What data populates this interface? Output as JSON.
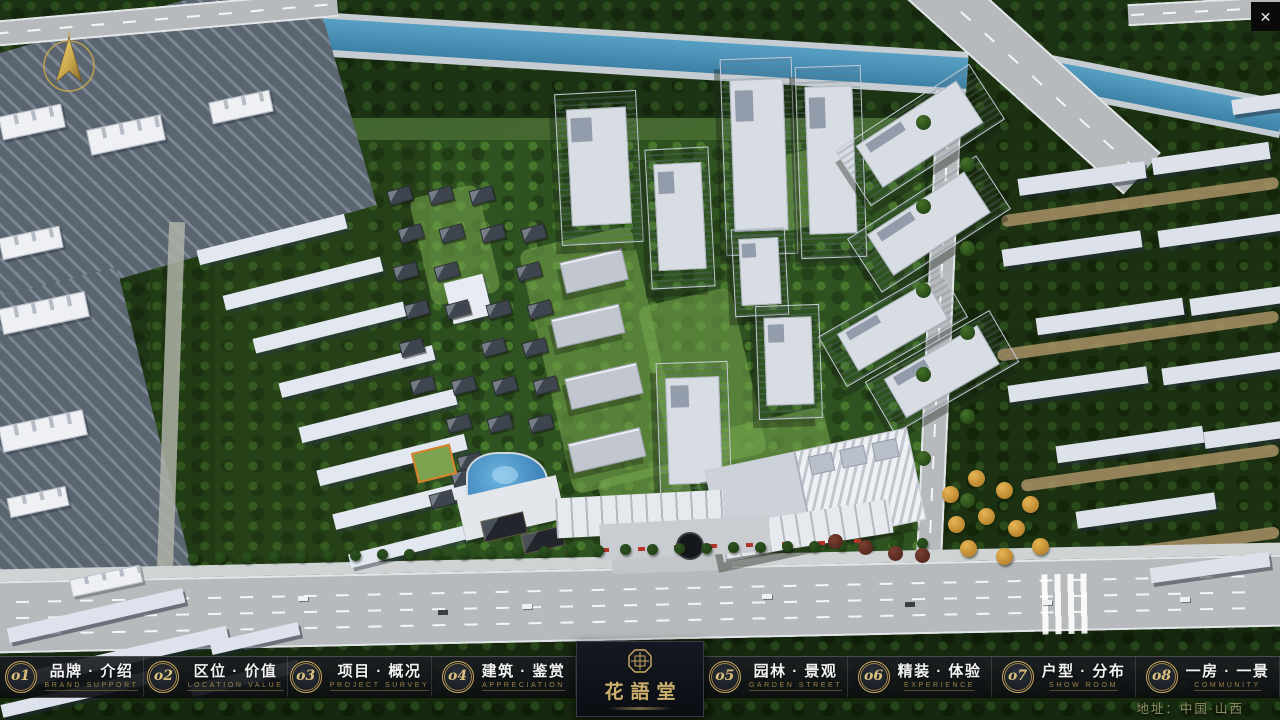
{
  "window": {
    "close_glyph": "✕"
  },
  "nav": {
    "items": [
      {
        "number": "o1",
        "title": "品牌 · 介绍",
        "subtitle": "BRAND SUPPORT"
      },
      {
        "number": "o2",
        "title": "区位 · 价值",
        "subtitle": "LOCATION VALUE"
      },
      {
        "number": "o3",
        "title": "项目 · 概况",
        "subtitle": "PROJECT SURVEY"
      },
      {
        "number": "o4",
        "title": "建筑 · 鉴赏",
        "subtitle": "APPRECIATION"
      },
      {
        "number": "o5",
        "title": "园林 · 景观",
        "subtitle": "GARDEN STREET"
      },
      {
        "number": "o6",
        "title": "精装 · 体验",
        "subtitle": "EXPERIENCE"
      },
      {
        "number": "o7",
        "title": "户型 · 分布",
        "subtitle": "SHOW ROOM"
      },
      {
        "number": "o8",
        "title": "一房 · 一景",
        "subtitle": "COMMUNITY"
      }
    ]
  },
  "logo": {
    "name": "花語堂"
  },
  "footer": {
    "address": "地址：中国·山西"
  },
  "colors": {
    "gold": "#c9ab63",
    "nav_bg": "#14171c",
    "title": "#f0f2f3",
    "subtitle": "#9a8348",
    "river": "#4b9ac2"
  }
}
